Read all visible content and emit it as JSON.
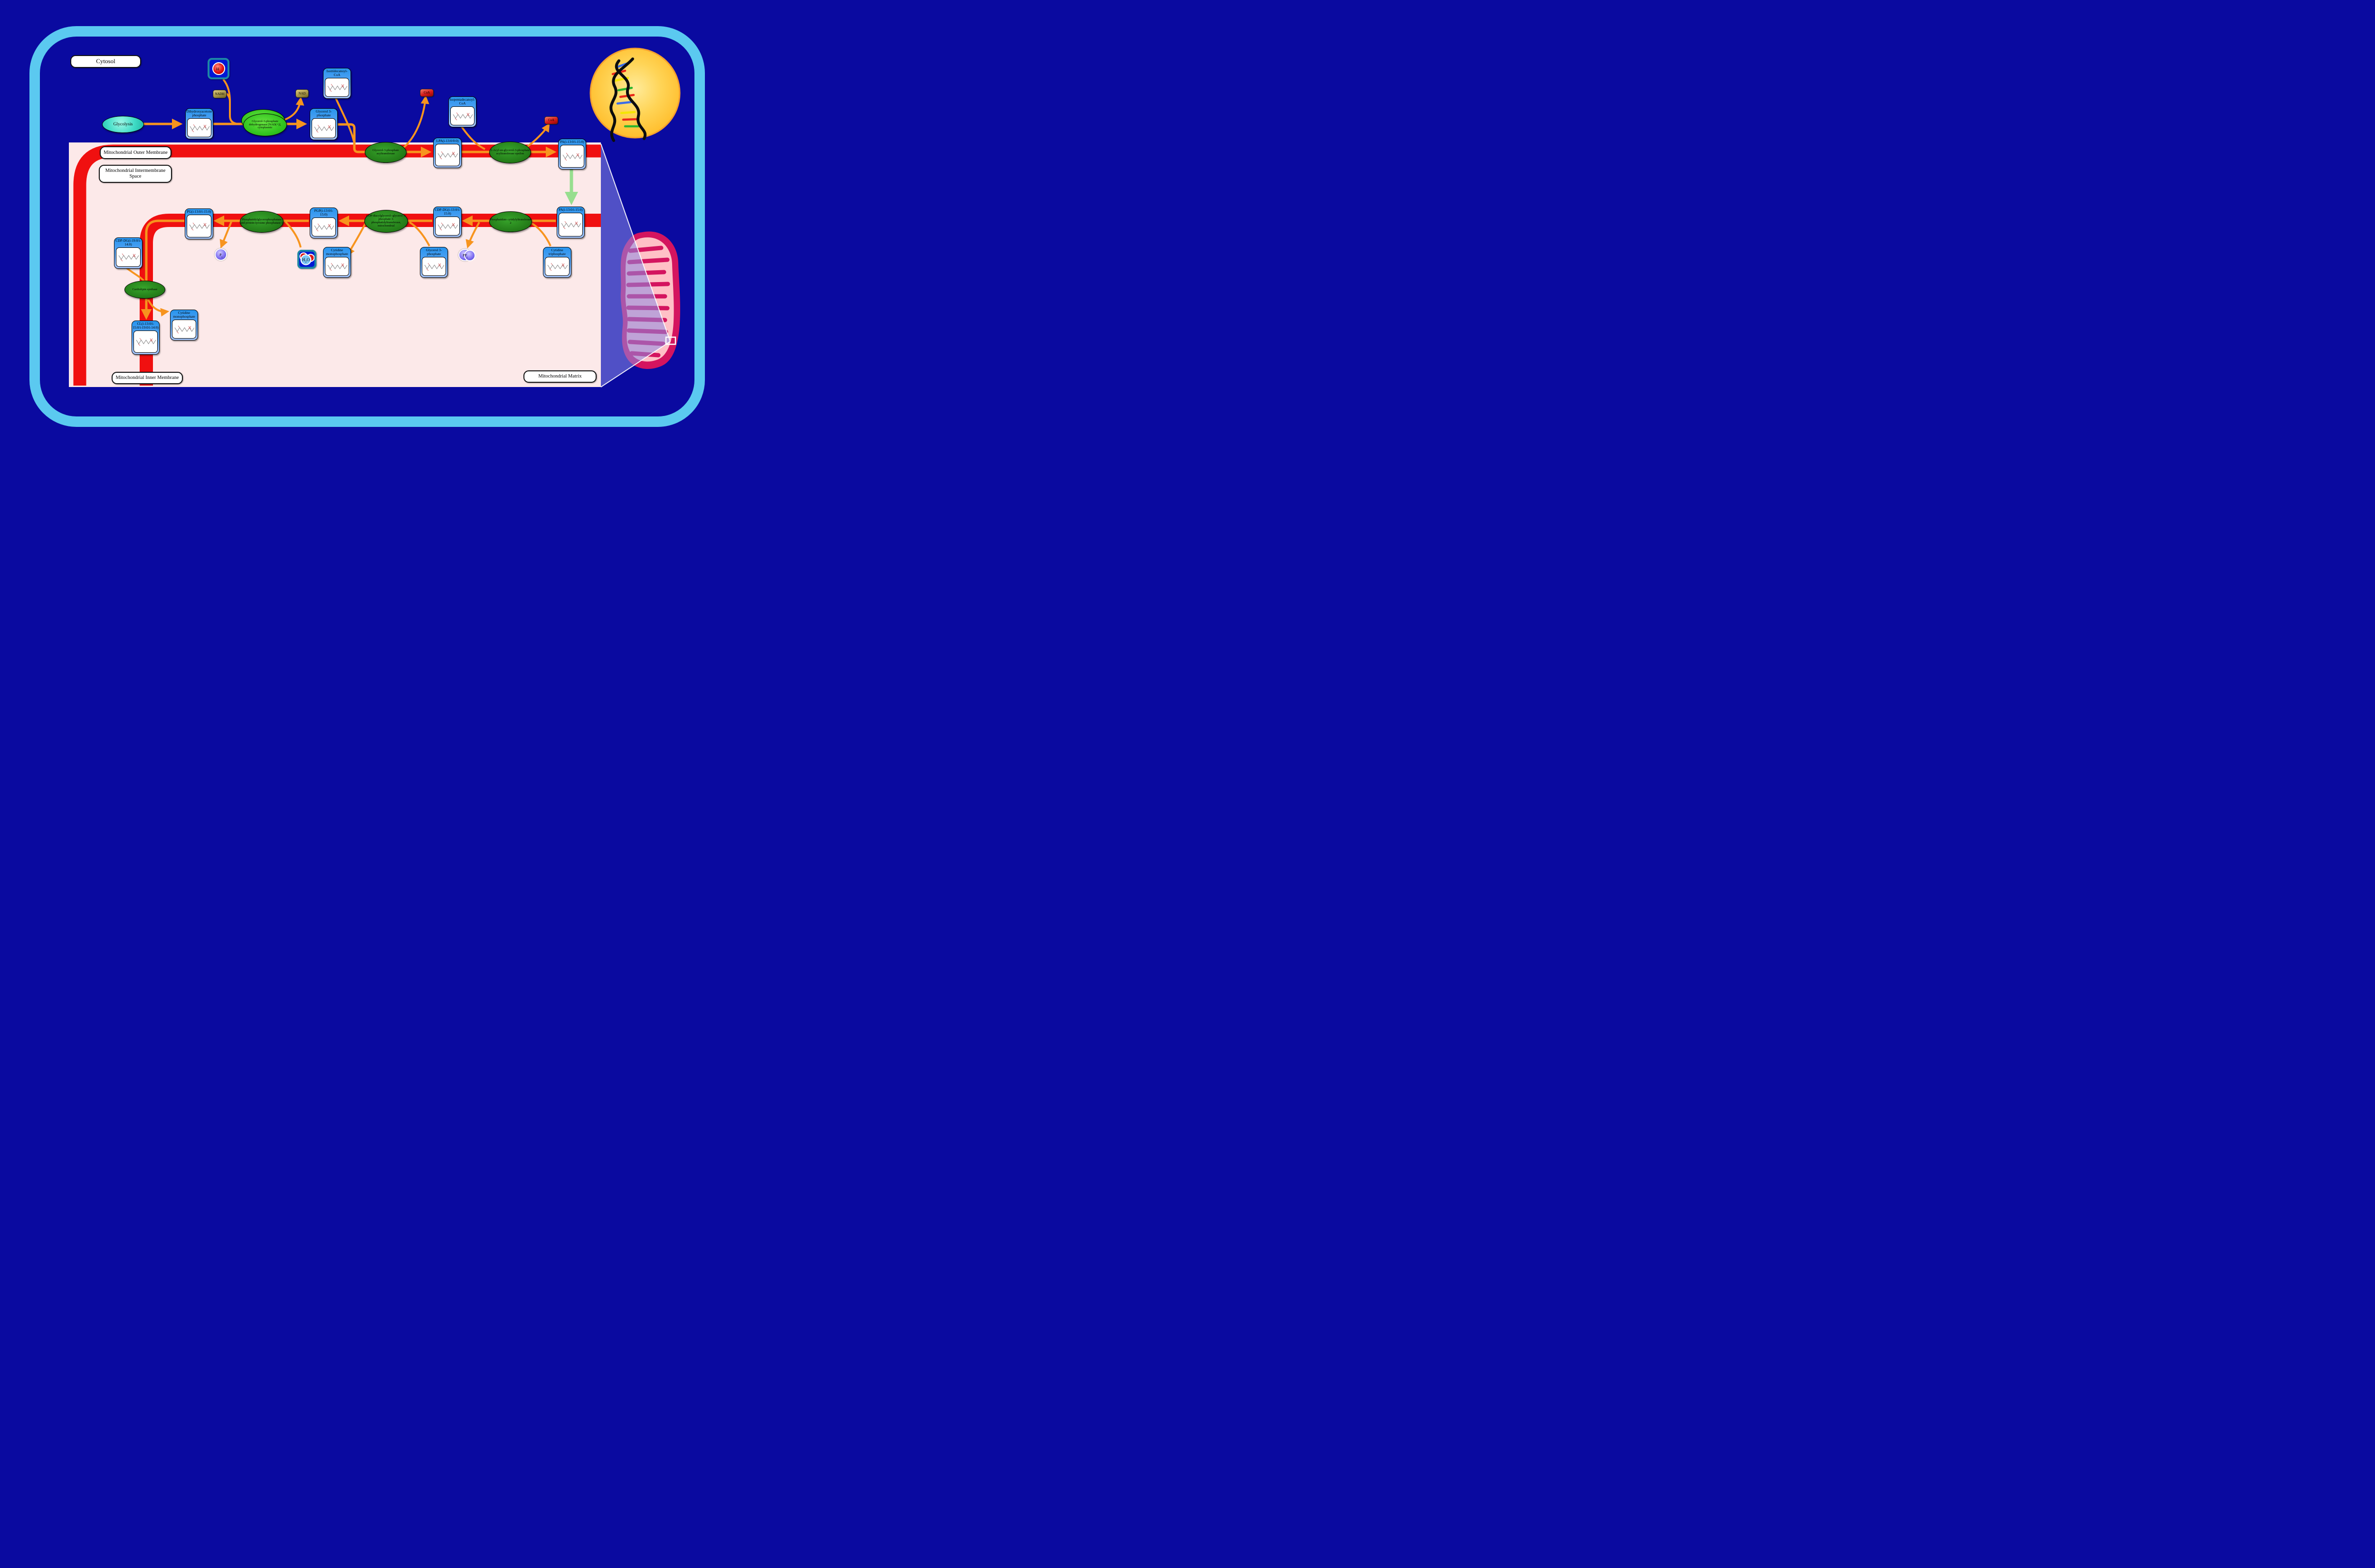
{
  "regions": {
    "cytosol": "Cytosol",
    "outer_membrane": "Mitochondrial Outer Membrane",
    "intermembrane_space": "Mitochondrial Intermembrane Space",
    "inner_membrane": "Mitochondrial Inner Membrane",
    "matrix": "Mitochondrial Matrix"
  },
  "glycolysis_label": "Glycolysis",
  "metabolites": [
    {
      "id": "dhap",
      "label": "Dihydroxyacetone phosphate"
    },
    {
      "id": "g3p_top",
      "label": "Glycerol 3-phosphate"
    },
    {
      "id": "isotridecanoyl_coa",
      "label": "Isotridecanoyl-CoA"
    },
    {
      "id": "lpa",
      "label": "LPA(i-13:0/0:0)"
    },
    {
      "id": "isopentadecanoyl_coa",
      "label": "Isopentadecanoyl-CoA"
    },
    {
      "id": "pa_top",
      "label": "PA(i-13:0/i-15:0)"
    },
    {
      "id": "pg",
      "label": "PG(i-13:0/i-15:0)"
    },
    {
      "id": "pgp",
      "label": "PGP(i-13:0/i-15:0)"
    },
    {
      "id": "cdpdg_13_15",
      "label": "CDP-DG(i-13:0/i-15:0)"
    },
    {
      "id": "pa_mid",
      "label": "PA(i-13:0/i-15:0)"
    },
    {
      "id": "cdpdg_19_14",
      "label": "CDP-DG(i-19:0/i-14:0)"
    },
    {
      "id": "cmp_mid",
      "label": "Cytidine monophosphate"
    },
    {
      "id": "g3p_low",
      "label": "Glycerol 3-phosphate"
    },
    {
      "id": "ctp",
      "label": "Cytidine triphosphate"
    },
    {
      "id": "cmp_low",
      "label": "Cytidine monophosphate"
    },
    {
      "id": "cl",
      "label": "CL(i-13:0/i-15:0/i-19:0/i-14:0)"
    }
  ],
  "enzymes": [
    {
      "id": "gpd_cyto",
      "label": "Glycerol-3-phosphate dehydrogenase [NAD(+)], cytoplasmic",
      "style": "bright"
    },
    {
      "id": "gpat",
      "label": "Glycerol-3-phosphate acyltransferase",
      "style": "dark"
    },
    {
      "id": "agpat",
      "label": "1-Acyl-sn-glycerol-3-phosphate acyltransferase epsilon",
      "style": "dark"
    },
    {
      "id": "ptpmt1",
      "label": "Phosphatidylglycerophosphatase and protein-tyrosine phosphatase 1",
      "style": "dark"
    },
    {
      "id": "pgs1",
      "label": "CDP-diacylglycerol--glycerol-3-phosphate 3-phosphatidyltransferase, mitochondrial",
      "style": "dark"
    },
    {
      "id": "cds2",
      "label": "Phosphatidate cytidylyltransferase 2",
      "style": "dark"
    },
    {
      "id": "cls",
      "label": "Cardiolipin synthase",
      "style": "dark"
    }
  ],
  "cofactors": [
    {
      "id": "h_plus",
      "base": "H",
      "sup": "+",
      "type": "proton"
    },
    {
      "id": "nadh",
      "base": "NADH",
      "type": "khaki"
    },
    {
      "id": "nad",
      "base": "NAD",
      "type": "khaki"
    },
    {
      "id": "coa_1",
      "base": "CoA",
      "type": "red"
    },
    {
      "id": "coa_2",
      "base": "CoA",
      "type": "red"
    },
    {
      "id": "h2o",
      "base": "H",
      "sub": "2",
      "rest": "O",
      "type": "water"
    },
    {
      "id": "pi",
      "base": "P",
      "sub": "i",
      "type": "purple"
    },
    {
      "id": "ppi",
      "base": "PP",
      "sub": "i",
      "type": "purple2"
    }
  ],
  "icons": {
    "nucleus": "nucleus-dna-icon",
    "mitochondrion": "mitochondrion-icon",
    "water": "water-molecule-icon",
    "proton": "proton-icon",
    "structures": "molecule-structure-icon",
    "zoom_box": "zoom-region-indicator"
  },
  "colors": {
    "background": "#0a0aa0",
    "cell_border": "#5bc9f0",
    "compartment_pink": "#fce9e9",
    "membrane_red": "#f01010",
    "arrow_orange": "#f7941e",
    "transport_green": "#97de8f",
    "enzyme_green": "#247d19",
    "enzyme_bright_green": "#32c41f",
    "metabolite_blue": "#2794ee",
    "nucleus_yellow": "#ffc93e",
    "mitochondrion_crimson": "#d4145f"
  }
}
